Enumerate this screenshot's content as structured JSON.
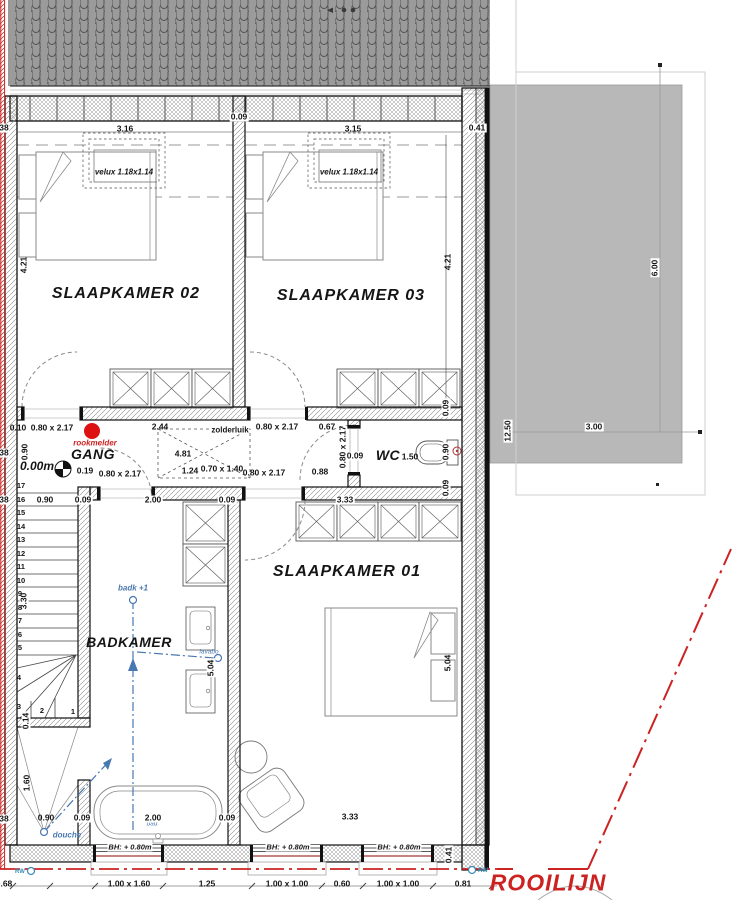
{
  "plan": {
    "colors": {
      "rooilijn_red": "#cc2222",
      "plumbing_blue": "#4878b0",
      "terrace_gray": "#b8b8b8",
      "roof_gray": "#9b9b9b",
      "smoke_detector_red": "#dd1111"
    },
    "rooms": {
      "sk02": "SLAAPKAMER 02",
      "sk03": "SLAAPKAMER 03",
      "sk01": "SLAAPKAMER 01",
      "gang": "GANG",
      "wc": "WC",
      "badkamer": "BADKAMER"
    },
    "labels": [
      {
        "n": "room-label-sk02",
        "t": "SLAAPKAMER 02",
        "x": 126,
        "y": 294,
        "k": "r1"
      },
      {
        "n": "room-label-sk03",
        "t": "SLAAPKAMER 03",
        "x": 351,
        "y": 296,
        "k": "r1"
      },
      {
        "n": "room-label-sk01",
        "t": "SLAAPKAMER 01",
        "x": 347,
        "y": 572,
        "k": "r1"
      },
      {
        "n": "room-label-gang",
        "t": "GANG",
        "x": 93,
        "y": 454,
        "k": "r2"
      },
      {
        "n": "room-label-wc",
        "t": "WC",
        "x": 388,
        "y": 455,
        "k": "r2"
      },
      {
        "n": "room-label-badkamer",
        "t": "BADKAMER",
        "x": 129,
        "y": 642,
        "k": "r2"
      },
      {
        "n": "wc-area-label",
        "t": "1.50",
        "x": 410,
        "y": 457,
        "k": "d"
      },
      {
        "n": "velux-label-sk02",
        "t": "velux 1.18x1.14",
        "x": 124,
        "y": 172,
        "k": "vx"
      },
      {
        "n": "velux-label-sk03",
        "t": "velux 1.18x1.14",
        "x": 349,
        "y": 172,
        "k": "vx"
      },
      {
        "n": "smoke-detector-label",
        "t": "rookmelder",
        "x": 95,
        "y": 443,
        "k": "rn"
      },
      {
        "n": "level-label",
        "t": "0.00m",
        "x": 37,
        "y": 466,
        "k": "lv"
      },
      {
        "n": "attic-hatch-label",
        "t": "zolderluik",
        "x": 230,
        "y": 430,
        "k": "zd"
      },
      {
        "n": "badk-note",
        "t": "badk +1",
        "x": 133,
        "y": 588,
        "k": "bl"
      },
      {
        "n": "lavabo-note",
        "t": "lavabo",
        "x": 209,
        "y": 652,
        "k": "bs"
      },
      {
        "n": "douche-note",
        "t": "douche",
        "x": 67,
        "y": 835,
        "k": "bl"
      },
      {
        "n": "bad-note",
        "t": "bad",
        "x": 152,
        "y": 824,
        "k": "bs"
      },
      {
        "n": "rw-left-note",
        "t": "RW",
        "x": 20,
        "y": 872,
        "k": "rw"
      },
      {
        "n": "rw-right-note",
        "t": "RW",
        "x": 483,
        "y": 871,
        "k": "rw"
      },
      {
        "n": "rooilijn-label",
        "t": "ROOILIJN",
        "x": 548,
        "y": 883,
        "k": "ro"
      },
      {
        "n": "window-head-note",
        "t": "BH: + 0.80m",
        "x": 130,
        "y": 847,
        "k": "bh"
      },
      {
        "n": "window-head-note",
        "t": "BH: + 0.80m",
        "x": 288,
        "y": 847,
        "k": "bh"
      },
      {
        "n": "window-head-note",
        "t": "BH: + 0.80m",
        "x": 399,
        "y": 847,
        "k": "bh"
      },
      {
        "t": "38",
        "x": 4,
        "y": 128,
        "k": "db"
      },
      {
        "t": "3.16",
        "x": 125,
        "y": 129,
        "k": "d"
      },
      {
        "t": "0.09",
        "x": 239,
        "y": 117,
        "k": "db"
      },
      {
        "t": "3.15",
        "x": 353,
        "y": 129,
        "k": "d"
      },
      {
        "t": "0.41",
        "x": 477,
        "y": 128,
        "k": "db"
      },
      {
        "t": "4.21",
        "x": 24,
        "y": 265,
        "k": "d",
        "r": 1
      },
      {
        "t": "4.21",
        "x": 448,
        "y": 262,
        "k": "d",
        "r": 1
      },
      {
        "t": "6.00",
        "x": 655,
        "y": 268,
        "k": "db",
        "r": 1
      },
      {
        "t": "12.50",
        "x": 508,
        "y": 431,
        "k": "db",
        "r": 1
      },
      {
        "t": "3.00",
        "x": 594,
        "y": 427,
        "k": "db"
      },
      {
        "t": "0.10",
        "x": 18,
        "y": 428,
        "k": "d"
      },
      {
        "t": "0.80 x 2.17",
        "x": 52,
        "y": 428,
        "k": "d"
      },
      {
        "t": "2.44",
        "x": 160,
        "y": 427,
        "k": "d"
      },
      {
        "t": "0.80 x 2.17",
        "x": 277,
        "y": 427,
        "k": "d"
      },
      {
        "t": "0.67",
        "x": 327,
        "y": 427,
        "k": "d"
      },
      {
        "t": "4.81",
        "x": 183,
        "y": 454,
        "k": "d"
      },
      {
        "t": "0.19",
        "x": 85,
        "y": 471,
        "k": "d"
      },
      {
        "t": "0.80 x 2.17",
        "x": 120,
        "y": 474,
        "k": "d"
      },
      {
        "t": "1.24",
        "x": 190,
        "y": 471,
        "k": "d"
      },
      {
        "t": "0.70 x 1.40",
        "x": 222,
        "y": 469,
        "k": "d"
      },
      {
        "t": "0.80 x 2.17",
        "x": 264,
        "y": 473,
        "k": "d"
      },
      {
        "t": "0.88",
        "x": 320,
        "y": 472,
        "k": "d"
      },
      {
        "t": "0.80 x 2.17",
        "x": 343,
        "y": 447,
        "k": "d",
        "r": 1
      },
      {
        "t": "0.09",
        "x": 355,
        "y": 456,
        "k": "db"
      },
      {
        "t": "0.09",
        "x": 446,
        "y": 408,
        "k": "db",
        "r": 1
      },
      {
        "t": "0.90",
        "x": 446,
        "y": 452,
        "k": "db",
        "r": 1
      },
      {
        "t": "0.09",
        "x": 446,
        "y": 488,
        "k": "db",
        "r": 1
      },
      {
        "t": "0.90",
        "x": 25,
        "y": 452,
        "k": "d",
        "r": 1
      },
      {
        "t": "38",
        "x": 4,
        "y": 453,
        "k": "db"
      },
      {
        "t": "38",
        "x": 4,
        "y": 500,
        "k": "db"
      },
      {
        "t": "0.90",
        "x": 45,
        "y": 500,
        "k": "db"
      },
      {
        "t": "0.09",
        "x": 83,
        "y": 500,
        "k": "db"
      },
      {
        "t": "2.00",
        "x": 153,
        "y": 500,
        "k": "db"
      },
      {
        "t": "0.09",
        "x": 227,
        "y": 500,
        "k": "db"
      },
      {
        "t": "3.33",
        "x": 345,
        "y": 500,
        "k": "db"
      },
      {
        "t": "3.30",
        "x": 24,
        "y": 601,
        "k": "db",
        "r": 1
      },
      {
        "t": "0.14",
        "x": 26,
        "y": 721,
        "k": "db",
        "r": 1
      },
      {
        "t": "1.60",
        "x": 27,
        "y": 783,
        "k": "d",
        "r": 1
      },
      {
        "t": "38",
        "x": 4,
        "y": 819,
        "k": "db"
      },
      {
        "t": "0.90",
        "x": 46,
        "y": 818,
        "k": "d"
      },
      {
        "t": "0.09",
        "x": 82,
        "y": 818,
        "k": "db"
      },
      {
        "t": "2.00",
        "x": 153,
        "y": 818,
        "k": "db"
      },
      {
        "t": "0.09",
        "x": 227,
        "y": 818,
        "k": "db"
      },
      {
        "t": "3.33",
        "x": 350,
        "y": 817,
        "k": "d"
      },
      {
        "t": "5.04",
        "x": 211,
        "y": 668,
        "k": "db",
        "r": 1
      },
      {
        "t": "5.04",
        "x": 448,
        "y": 663,
        "k": "d",
        "r": 1
      },
      {
        "t": "0.41",
        "x": 449,
        "y": 855,
        "k": "db",
        "r": 1
      },
      {
        "t": "0.68",
        "x": 4,
        "y": 884,
        "k": "d"
      },
      {
        "t": "1.00 x 1.60",
        "x": 129,
        "y": 884,
        "k": "d"
      },
      {
        "t": "1.25",
        "x": 207,
        "y": 884,
        "k": "d"
      },
      {
        "t": "1.00 x 1.00",
        "x": 287,
        "y": 884,
        "k": "d"
      },
      {
        "t": "0.60",
        "x": 342,
        "y": 884,
        "k": "d"
      },
      {
        "t": "1.00 x 1.00",
        "x": 398,
        "y": 884,
        "k": "d"
      },
      {
        "t": "0.81",
        "x": 463,
        "y": 884,
        "k": "d"
      },
      {
        "n": "stair-step-number",
        "t": "17",
        "x": 21,
        "y": 486,
        "k": "n"
      },
      {
        "n": "stair-step-number",
        "t": "16",
        "x": 21,
        "y": 500,
        "k": "n"
      },
      {
        "n": "stair-step-number",
        "t": "15",
        "x": 21,
        "y": 513,
        "k": "n"
      },
      {
        "n": "stair-step-number",
        "t": "14",
        "x": 21,
        "y": 527,
        "k": "n"
      },
      {
        "n": "stair-step-number",
        "t": "13",
        "x": 21,
        "y": 540,
        "k": "n"
      },
      {
        "n": "stair-step-number",
        "t": "12",
        "x": 21,
        "y": 554,
        "k": "n"
      },
      {
        "n": "stair-step-number",
        "t": "11",
        "x": 21,
        "y": 567,
        "k": "n"
      },
      {
        "n": "stair-step-number",
        "t": "10",
        "x": 21,
        "y": 581,
        "k": "n"
      },
      {
        "n": "stair-step-number",
        "t": "9",
        "x": 20,
        "y": 594,
        "k": "n"
      },
      {
        "n": "stair-step-number",
        "t": "8",
        "x": 20,
        "y": 608,
        "k": "n"
      },
      {
        "n": "stair-step-number",
        "t": "7",
        "x": 20,
        "y": 621,
        "k": "n"
      },
      {
        "n": "stair-step-number",
        "t": "6",
        "x": 20,
        "y": 635,
        "k": "n"
      },
      {
        "n": "stair-step-number",
        "t": "5",
        "x": 20,
        "y": 648,
        "k": "n"
      },
      {
        "n": "stair-step-number",
        "t": "4",
        "x": 19,
        "y": 678,
        "k": "n"
      },
      {
        "n": "stair-step-number",
        "t": "3",
        "x": 19,
        "y": 707,
        "k": "n"
      },
      {
        "n": "stair-step-number",
        "t": "2",
        "x": 42,
        "y": 711,
        "k": "n"
      },
      {
        "n": "stair-step-number",
        "t": "1",
        "x": 73,
        "y": 712,
        "k": "n"
      }
    ]
  }
}
